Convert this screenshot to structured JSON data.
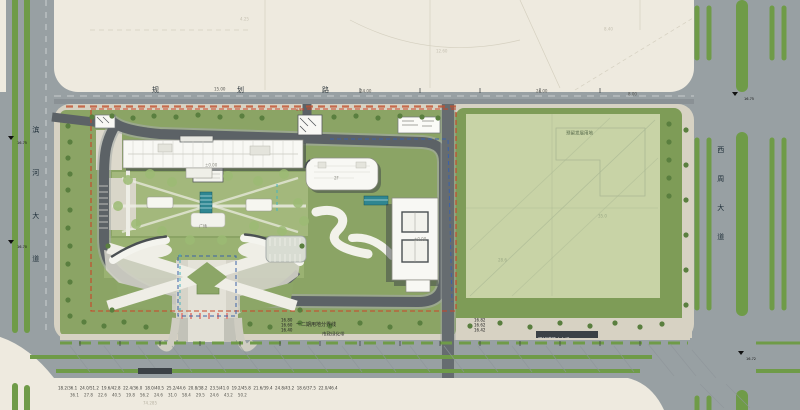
{
  "drawing": {
    "kind": "architectural site plan"
  },
  "colors": {
    "road_gray": "#98a0a3",
    "paper_beige": "#eeeadf",
    "sidewalk": "#d7d2c3",
    "site_green": "#8ba465",
    "courtyard_green": "#a3b87c",
    "field_pale_green": "#c8d3a6",
    "field_frame_green": "#7e9c57",
    "median_green": "#6f9b48",
    "ring_road_gray": "#5c6266",
    "building_white": "#f8f8f4",
    "shadow_gray": "#3c4145",
    "boundary_red": "#cc4426",
    "dash_blue": "#3b62a8",
    "dash_cyan": "#45b5c0",
    "water_teal": "#2f8691"
  },
  "roads": {
    "left_name": "滨河大道",
    "top_name": "规划路",
    "right_name": "西周大道",
    "chip_left": "道路中心线标高",
    "chip_right": "现状道路中心线"
  },
  "site": {
    "boundary_label": "一二期用地分界线",
    "verge_label": "市政绿化带",
    "field_label": "预留发展用地",
    "plaza_label": "广场",
    "spot_levels_left": "16.80\n16.60\n16.40",
    "spot_levels_right": "16.82\n16.62\n16.42"
  },
  "markers": {
    "left_a": "16.75",
    "left_b": "16.70",
    "right_a": "16.75",
    "right_b": "16.72"
  },
  "annotations": {
    "top_dims": [
      "15.00",
      "24.00",
      "24.00",
      "8.00"
    ],
    "red_dim": "6.25",
    "paper_faint": [
      "4.25",
      "12.60",
      "8.40"
    ],
    "field_nums": [
      "35.0",
      "28.6"
    ],
    "building_marks": [
      "±0.00",
      "±0.00",
      "2F"
    ],
    "bottom_dims_line1": "18.2/36.1  24.0/51.2  19.6/42.8  22.4/36.0  18.0/40.5  25.2/44.6  20.8/38.2  23.5/41.0  19.2/45.8  21.6/39.4  24.8/43.2  18.6/37.5  22.0/46.4",
    "bottom_dims_line2": "36.1    27.8    22.6    40.5    19.8    56.2    24.6    31.0    58.4    29.5    24.6    43.2    50.2",
    "bottom_faint": "74.285"
  }
}
